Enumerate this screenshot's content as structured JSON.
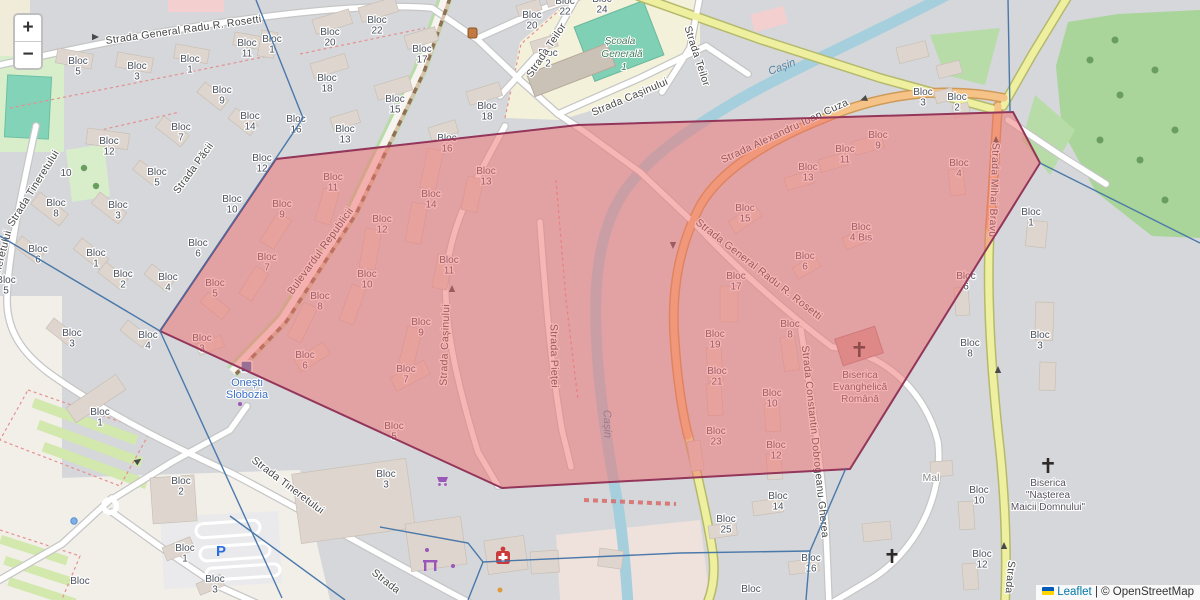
{
  "ui": {
    "zoom_in_label": "+",
    "zoom_out_label": "−",
    "attribution": {
      "flag_icon": "ukraine-flag",
      "leaflet_label": "Leaflet",
      "separator": " | ",
      "copyright_label": "© OpenStreetMap"
    }
  },
  "colors": {
    "selection_fill": "#f06e6e",
    "selection_stroke": "#93365a",
    "boundary_blue": "#4273a8",
    "water": "#a5cfdd",
    "forest": "#a9d49a",
    "road_primary_orange": "#f5c387",
    "road_secondary_yellow": "#eef0a0",
    "leaflet_link": "#0078a8",
    "station_blue": "#3f72b8"
  },
  "map_labels": {
    "blocks": [
      {
        "t": "Bloc 5",
        "x": 78,
        "y": 64
      },
      {
        "t": "Bloc 3",
        "x": 137,
        "y": 69
      },
      {
        "t": "Bloc 1",
        "x": 190,
        "y": 62
      },
      {
        "t": "Bloc 11",
        "x": 247,
        "y": 46
      },
      {
        "t": "Bloc 1",
        "x": 272,
        "y": 42
      },
      {
        "t": "Bloc 9",
        "x": 222,
        "y": 93
      },
      {
        "t": "Bloc 14",
        "x": 250,
        "y": 119
      },
      {
        "t": "Bloc 16",
        "x": 296,
        "y": 122
      },
      {
        "t": "Bloc 7",
        "x": 181,
        "y": 130
      },
      {
        "t": "Bloc 12",
        "x": 109,
        "y": 144
      },
      {
        "t": "10",
        "x": 66,
        "y": 176
      },
      {
        "t": "Bloc 5",
        "x": 157,
        "y": 175
      },
      {
        "t": "Bloc 8",
        "x": 56,
        "y": 206
      },
      {
        "t": "Bloc 10",
        "x": 232,
        "y": 202
      },
      {
        "t": "Bloc 3",
        "x": 118,
        "y": 208
      },
      {
        "t": "Bloc 6",
        "x": 38,
        "y": 252
      },
      {
        "t": "Bloc 1",
        "x": 96,
        "y": 256
      },
      {
        "t": "Bloc 6",
        "x": 198,
        "y": 246
      },
      {
        "t": "Bloc 2",
        "x": 123,
        "y": 277
      },
      {
        "t": "Bloc 4",
        "x": 168,
        "y": 280
      },
      {
        "t": "Bloc 5",
        "x": 6,
        "y": 283
      },
      {
        "t": "Bloc 3",
        "x": 72,
        "y": 336
      },
      {
        "t": "Bloc 4",
        "x": 148,
        "y": 338
      },
      {
        "t": "Bloc 20",
        "x": 330,
        "y": 35
      },
      {
        "t": "Bloc 22",
        "x": 377,
        "y": 23
      },
      {
        "t": "Bloc 17",
        "x": 422,
        "y": 52
      },
      {
        "t": "Bloc 18",
        "x": 327,
        "y": 81
      },
      {
        "t": "Bloc 15",
        "x": 395,
        "y": 102
      },
      {
        "t": "Bloc 13",
        "x": 345,
        "y": 132
      },
      {
        "t": "Bloc 18",
        "x": 487,
        "y": 109
      },
      {
        "t": "Bloc 22",
        "x": 565,
        "y": 4
      },
      {
        "t": "Bloc 20",
        "x": 532,
        "y": 18
      },
      {
        "t": "Bloc 2",
        "x": 548,
        "y": 56
      },
      {
        "t": "Bloc 24",
        "x": 602,
        "y": 2
      },
      {
        "t": "Bloc 16",
        "x": 447,
        "y": 141
      },
      {
        "t": "Bloc 13",
        "x": 486,
        "y": 174
      },
      {
        "t": "Bloc 14",
        "x": 431,
        "y": 197
      },
      {
        "t": "Bloc 12",
        "x": 382,
        "y": 222
      },
      {
        "t": "Bloc 11",
        "x": 333,
        "y": 180
      },
      {
        "t": "Bloc 9",
        "x": 282,
        "y": 207
      },
      {
        "t": "Bloc 12",
        "x": 262,
        "y": 161
      },
      {
        "t": "Bloc 7",
        "x": 267,
        "y": 260
      },
      {
        "t": "Bloc 11",
        "x": 449,
        "y": 263
      },
      {
        "t": "Bloc 10",
        "x": 367,
        "y": 277
      },
      {
        "t": "Bloc 8",
        "x": 320,
        "y": 299
      },
      {
        "t": "Bloc 9",
        "x": 421,
        "y": 325
      },
      {
        "t": "Bloc 6",
        "x": 305,
        "y": 358
      },
      {
        "t": "Bloc 7",
        "x": 406,
        "y": 372
      },
      {
        "t": "Bloc 5",
        "x": 215,
        "y": 286
      },
      {
        "t": "Bloc 3",
        "x": 202,
        "y": 341
      },
      {
        "t": "Bloc 9",
        "x": 878,
        "y": 138
      },
      {
        "t": "Bloc 11",
        "x": 845,
        "y": 152
      },
      {
        "t": "Bloc 13",
        "x": 808,
        "y": 170
      },
      {
        "t": "Bloc 15",
        "x": 745,
        "y": 211
      },
      {
        "t": "Bloc 3",
        "x": 923,
        "y": 95
      },
      {
        "t": "Bloc 2",
        "x": 957,
        "y": 100
      },
      {
        "t": "Bloc 4",
        "x": 959,
        "y": 166
      },
      {
        "t": "Bloc 4 Bis",
        "x": 861,
        "y": 230
      },
      {
        "t": "Bloc 6",
        "x": 805,
        "y": 259
      },
      {
        "t": "Bloc 17",
        "x": 736,
        "y": 279
      },
      {
        "t": "Bloc 8",
        "x": 790,
        "y": 327
      },
      {
        "t": "Bloc 19",
        "x": 715,
        "y": 337
      },
      {
        "t": "Bloc 21",
        "x": 717,
        "y": 374
      },
      {
        "t": "Bloc 23",
        "x": 716,
        "y": 434
      },
      {
        "t": "Bloc 10",
        "x": 772,
        "y": 396
      },
      {
        "t": "Bloc 12",
        "x": 776,
        "y": 448
      },
      {
        "t": "Bloc 6",
        "x": 966,
        "y": 279
      },
      {
        "t": "Bloc 8",
        "x": 970,
        "y": 346
      },
      {
        "t": "Bloc 1",
        "x": 1031,
        "y": 215
      },
      {
        "t": "Bloc 3",
        "x": 1040,
        "y": 338
      },
      {
        "t": "Bloc 14",
        "x": 778,
        "y": 499
      },
      {
        "t": "Bloc 25",
        "x": 726,
        "y": 522
      },
      {
        "t": "Bloc 16",
        "x": 811,
        "y": 561
      },
      {
        "t": "Bloc",
        "x": 751,
        "y": 592
      },
      {
        "t": "Bloc 10",
        "x": 979,
        "y": 493
      },
      {
        "t": "Bloc 12",
        "x": 982,
        "y": 557
      },
      {
        "t": "Bloc 1",
        "x": 100,
        "y": 415
      },
      {
        "t": "Bloc 2",
        "x": 181,
        "y": 484
      },
      {
        "t": "Bloc 1",
        "x": 185,
        "y": 551
      },
      {
        "t": "Bloc 3",
        "x": 215,
        "y": 582
      },
      {
        "t": "Bloc 5",
        "x": 394,
        "y": 429
      },
      {
        "t": "Bloc 3",
        "x": 386,
        "y": 477
      },
      {
        "t": "Bloc",
        "x": 80,
        "y": 584
      }
    ],
    "streets": [
      {
        "t": "Strada General Radu R. Rosetti",
        "x": 184,
        "y": 33,
        "r": -8
      },
      {
        "t": "Strada General Radu R. Rosetti",
        "x": 757,
        "y": 272,
        "r": 38
      },
      {
        "t": "Strada Păcii",
        "x": 196,
        "y": 170,
        "r": -54
      },
      {
        "t": "Strada Tineretului",
        "x": 36,
        "y": 190,
        "r": -58
      },
      {
        "t": "Strada Tineretului",
        "x": 0,
        "y": 274,
        "r": -75
      },
      {
        "t": "Strada Tineretului",
        "x": 286,
        "y": 488,
        "r": 37
      },
      {
        "t": "Strada",
        "x": 384,
        "y": 584,
        "r": 38
      },
      {
        "t": "Bulevardul Republicii",
        "x": 323,
        "y": 253,
        "r": -54
      },
      {
        "t": "Strada Teilor",
        "x": 549,
        "y": 52,
        "r": -56
      },
      {
        "t": "Strada Teilor",
        "x": 694,
        "y": 57,
        "r": 72
      },
      {
        "t": "Strada Cașinului",
        "x": 631,
        "y": 100,
        "r": -23
      },
      {
        "t": "Strada Cașinului",
        "x": 448,
        "y": 345,
        "r": -88
      },
      {
        "t": "Strada Pieței",
        "x": 551,
        "y": 356,
        "r": 89
      },
      {
        "t": "Strada Alexandru Ioan Cuza",
        "x": 786,
        "y": 134,
        "r": -25
      },
      {
        "t": "Strada Mihai Bravu",
        "x": 991,
        "y": 190,
        "r": 92
      },
      {
        "t": "Strada",
        "x": 1007,
        "y": 577,
        "r": 95
      },
      {
        "t": "Strada Constantin Dobrogeanu Gherea",
        "x": 812,
        "y": 442,
        "r": 84
      },
      {
        "t": "Cașin",
        "x": 783,
        "y": 70,
        "r": -21,
        "k": "water"
      },
      {
        "t": "Cașin",
        "x": 604,
        "y": 424,
        "r": 88,
        "k": "water"
      }
    ],
    "places": [
      {
        "t": "Școala",
        "x": 620,
        "y": 44,
        "k": "school"
      },
      {
        "t": "Generală",
        "x": 622,
        "y": 57,
        "k": "school"
      },
      {
        "t": "1",
        "x": 624,
        "y": 70,
        "k": "school"
      },
      {
        "t": "Onești",
        "x": 247,
        "y": 386,
        "k": "station"
      },
      {
        "t": "Slobozia",
        "x": 247,
        "y": 398,
        "k": "station"
      },
      {
        "t": "Biserica",
        "x": 860,
        "y": 378,
        "k": "poi"
      },
      {
        "t": "Evanghelică",
        "x": 860,
        "y": 390,
        "k": "poi"
      },
      {
        "t": "Română",
        "x": 860,
        "y": 402,
        "k": "poi"
      },
      {
        "t": "Biserica",
        "x": 1048,
        "y": 486,
        "k": "poi"
      },
      {
        "t": "\"Nașterea",
        "x": 1048,
        "y": 498,
        "k": "poi"
      },
      {
        "t": "Maicii Domnului\"",
        "x": 1048,
        "y": 510,
        "k": "poi"
      },
      {
        "t": "Mal",
        "x": 931,
        "y": 481,
        "k": "minor"
      },
      {
        "t": "P",
        "x": 221,
        "y": 556,
        "k": "parking"
      }
    ]
  }
}
